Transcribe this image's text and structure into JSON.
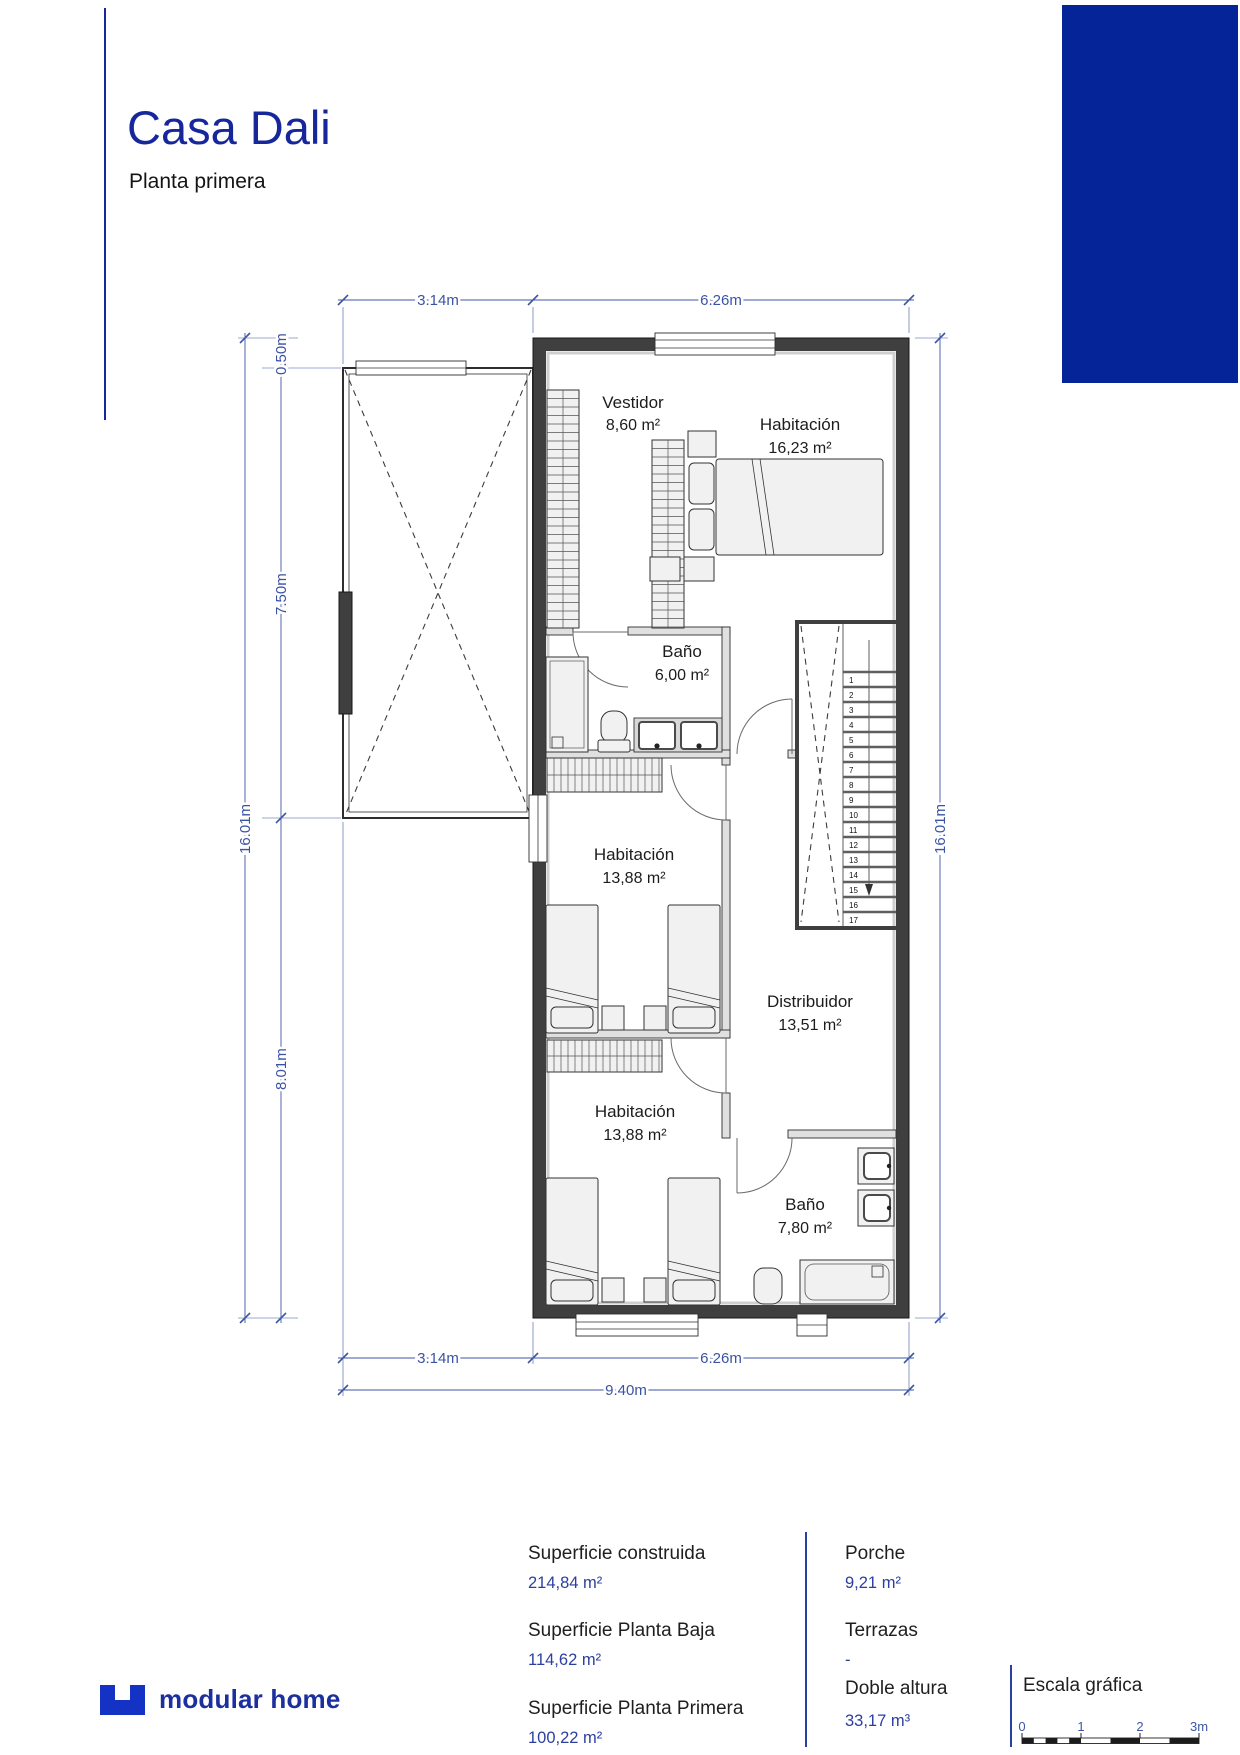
{
  "header": {
    "title": "Casa Dali",
    "subtitle": "Planta primera"
  },
  "plan": {
    "rooms": [
      {
        "name": "Vestidor",
        "area": "8,60 m²"
      },
      {
        "name": "Habitación",
        "area": "16,23 m²"
      },
      {
        "name": "Baño",
        "area": "6,00 m²"
      },
      {
        "name": "Habitación",
        "area": "13,88 m²"
      },
      {
        "name": "Distribuidor",
        "area": "13,51 m²"
      },
      {
        "name": "Habitación",
        "area": "13,88 m²"
      },
      {
        "name": "Baño",
        "area": "7,80 m²"
      }
    ],
    "dims": {
      "top_a": "3.14m",
      "top_b": "6.26m",
      "offset": "0.50m",
      "upper": "7.50m",
      "lower": "8.01m",
      "total_v": "16.01m",
      "bottom_a": "3.14m",
      "bottom_b": "6.26m",
      "total_h": "9.40m"
    },
    "stairs": [
      "1",
      "2",
      "3",
      "4",
      "5",
      "6",
      "7",
      "8",
      "9",
      "10",
      "11",
      "12",
      "13",
      "14",
      "15",
      "16",
      "17"
    ]
  },
  "summary": {
    "col1": [
      {
        "label": "Superficie construida",
        "value": "214,84 m²"
      },
      {
        "label": "Superficie Planta Baja",
        "value": "114,62 m²"
      },
      {
        "label": "Superficie Planta Primera",
        "value": "100,22 m²"
      }
    ],
    "col2": [
      {
        "label": "Porche",
        "value": "9,21 m²"
      },
      {
        "label": "Terrazas",
        "value": "-"
      },
      {
        "label": "Doble altura",
        "value": "33,17 m³"
      }
    ]
  },
  "scale": {
    "title": "Escala gráfica",
    "labels": [
      "0",
      "1",
      "2",
      "3m"
    ]
  },
  "logo": {
    "text": "modular home"
  },
  "colors": {
    "brand": "#16279b",
    "block": "#042498",
    "dims": "#3d56a4"
  }
}
